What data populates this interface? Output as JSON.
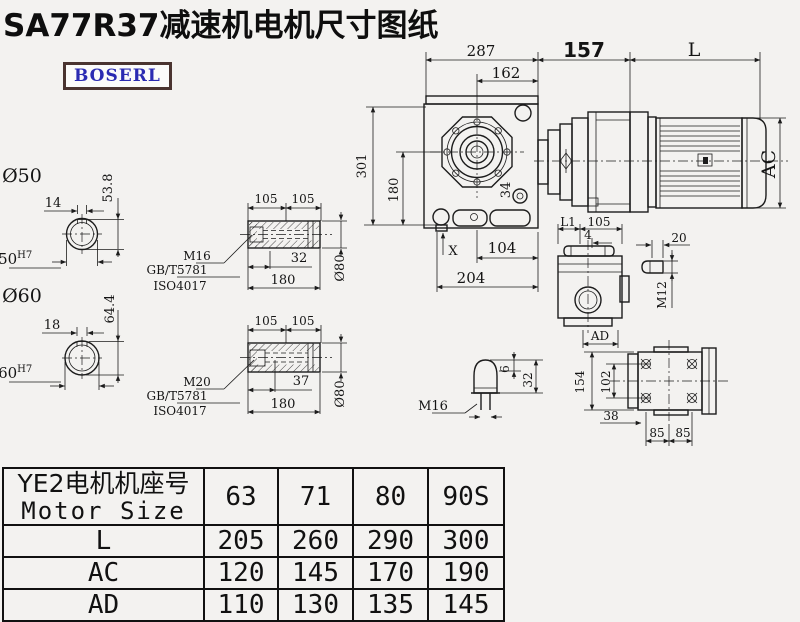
{
  "title": "SA77R37减速机电机尺寸图纸",
  "logo": {
    "text": "BOSERL"
  },
  "colors": {
    "logo_text": "#2b2bb2",
    "logo_border": "#4a3430",
    "line": "#1c1c1c",
    "background": "#f3f2f0"
  },
  "dims": {
    "d287": "287",
    "d162": "162",
    "d157": "157",
    "dL": "L",
    "d301": "301",
    "d180": "180",
    "d34": "34",
    "dX": "X",
    "d104": "104",
    "d204": "204",
    "dAC": "AC",
    "dL1": "L1",
    "d105": "105",
    "d4": "4",
    "dAD": "AD",
    "d20": "20",
    "dM12": "M12",
    "d6": "6",
    "d32cone": "32",
    "dM16cone": "M16",
    "d154": "154",
    "d102": "102",
    "d38": "38",
    "d85": "85"
  },
  "shaft50": {
    "label": "Ø50",
    "key_width": "14",
    "key_height": "53.8",
    "bore": "Ø50",
    "tolerance": "H7"
  },
  "shaft60": {
    "label": "Ø60",
    "key_width": "18",
    "key_height": "64.4",
    "bore": "Ø60",
    "tolerance": "H7"
  },
  "sleeve1": {
    "d105a": "105",
    "d105b": "105",
    "bolt_len": "32",
    "total_len": "180",
    "dia": "Ø80",
    "thread": "M16",
    "std1": "GB/T5781",
    "std2": "ISO4017"
  },
  "sleeve2": {
    "d105a": "105",
    "d105b": "105",
    "bolt_len": "37",
    "total_len": "180",
    "dia": "Ø80",
    "thread": "M20",
    "std1": "GB/T5781",
    "std2": "ISO4017"
  },
  "table": {
    "header_cn": "YE2电机机座号",
    "header_en": "Motor Size",
    "sizes": [
      "63",
      "71",
      "80",
      "90S"
    ],
    "rows": [
      {
        "label": "L",
        "values": [
          "205",
          "260",
          "290",
          "300"
        ]
      },
      {
        "label": "AC",
        "values": [
          "120",
          "145",
          "170",
          "190"
        ]
      },
      {
        "label": "AD",
        "values": [
          "110",
          "130",
          "135",
          "145"
        ]
      }
    ]
  }
}
